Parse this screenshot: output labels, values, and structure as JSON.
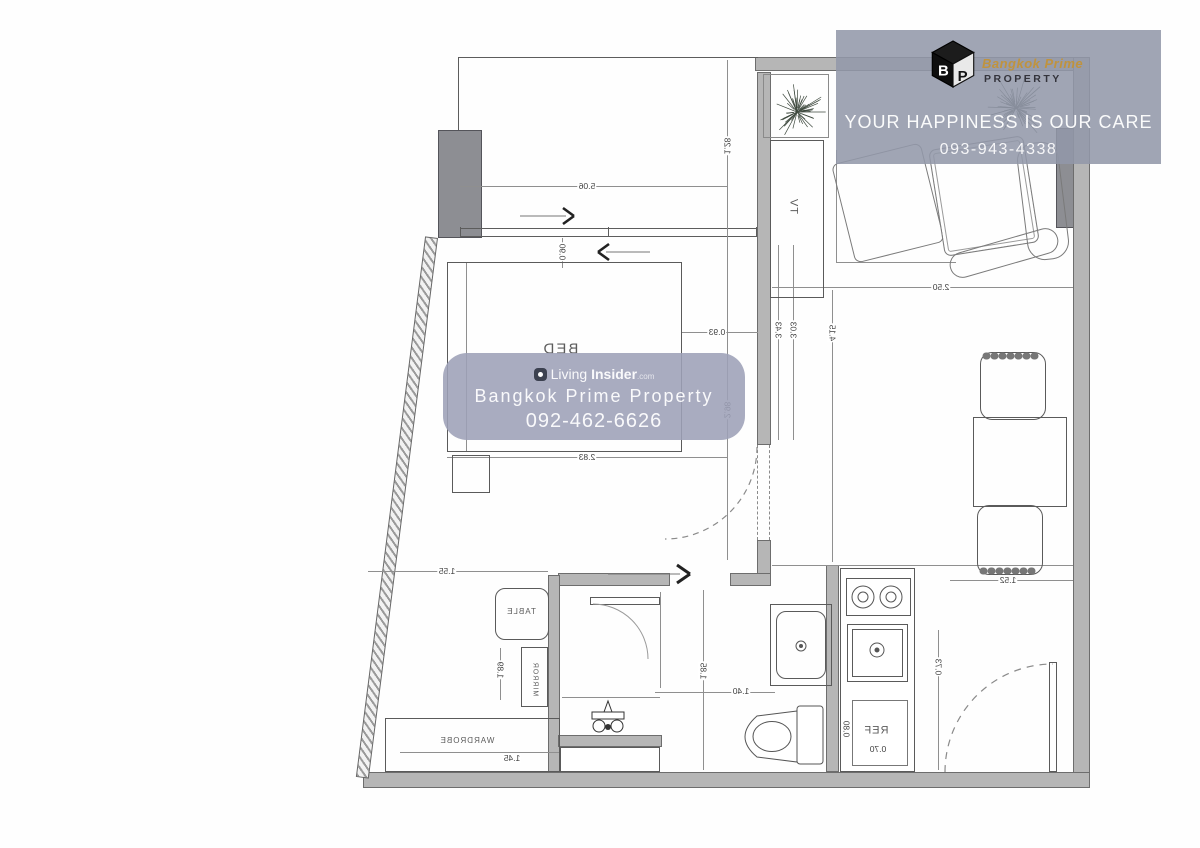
{
  "watermark_top": {
    "brand_line1": "Bangkok Prime",
    "brand_line2": "PROPERTY",
    "tagline": "YOUR HAPPINESS IS OUR CARE",
    "phone": "093-943-4338"
  },
  "watermark_center": {
    "brand_regular": "Living",
    "brand_bold": "Insider",
    "brand_tld": ".com",
    "line2": "Bangkok Prime Property",
    "phone": "092-462-6626"
  },
  "colors": {
    "wall": "#b6b6b6",
    "column": "#8d8e93",
    "plan_line": "#5c5c5c",
    "watermark_top_bg": "#929aa9",
    "watermark_center_bg": "#9da1b7",
    "logo_orange": "#c7922a"
  },
  "floorplan": {
    "style": "mirrored architectural plan",
    "labels": {
      "bed": "BED",
      "tv": "TV",
      "ref": "REF",
      "table": "TABLE",
      "mirror": "MIRROR",
      "wardrobe": "WARDROBE"
    },
    "dims": [
      {
        "text": "5.06"
      },
      {
        "text": "1.28"
      },
      {
        "text": "0.90"
      },
      {
        "text": "0.93"
      },
      {
        "text": "3.43"
      },
      {
        "text": "3.03"
      },
      {
        "text": "4.15"
      },
      {
        "text": "2.50"
      },
      {
        "text": "2.98"
      },
      {
        "text": "2.83"
      },
      {
        "text": "1.55"
      },
      {
        "text": "1.52"
      },
      {
        "text": "1.89"
      },
      {
        "text": "1.85"
      },
      {
        "text": "1.40"
      },
      {
        "text": "0.73"
      },
      {
        "text": "0.80"
      },
      {
        "text": "0.70"
      },
      {
        "text": "1.45"
      }
    ]
  }
}
